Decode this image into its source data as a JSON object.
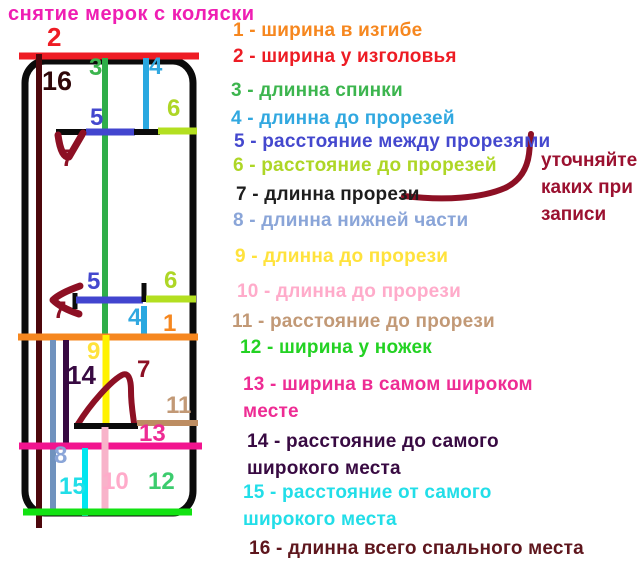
{
  "header": {
    "title": "снятие мерок с коляски",
    "color": "#ef1eb3"
  },
  "note": {
    "text": "уточняйте\nкаких при\nзаписи",
    "color": "#9b1130"
  },
  "diagram": {
    "stroke_colors": {
      "black": "#0b0b0b",
      "red": "#ee1c24",
      "maroon": "#4d070c",
      "green": "#2fae49",
      "turquoise": "#29a8e0",
      "indigo": "#4245cf",
      "lime": "#b3df20",
      "darkred": "#8d1024",
      "orange": "#f6871f",
      "bluegray": "#7092be",
      "darkpurple": "#380a42",
      "yellow": "#fff200",
      "brown": "#bd8d62",
      "deeppink": "#f2148f",
      "rose": "#f8b3ca",
      "cyan": "#00e6f0",
      "brightgreen": "#12e212",
      "note_arrow": "#8d1024"
    },
    "labels": [
      {
        "t": "2",
        "c": "#ee1c24"
      },
      {
        "t": "16",
        "c": "#2f0709"
      },
      {
        "t": "3",
        "c": "#3cb54e"
      },
      {
        "t": "4",
        "c": "#31a8e0"
      },
      {
        "t": "5",
        "c": "#4448ce"
      },
      {
        "t": "6",
        "c": "#aed626"
      },
      {
        "t": "7",
        "c": "#8d1024"
      },
      {
        "t": "5",
        "c": "#4448ce"
      },
      {
        "t": "6",
        "c": "#aed626"
      },
      {
        "t": "7",
        "c": "#8d1024"
      },
      {
        "t": "4",
        "c": "#31a8e0"
      },
      {
        "t": "1",
        "c": "#f6871f"
      },
      {
        "t": "9",
        "c": "#ffe23c"
      },
      {
        "t": "14",
        "c": "#380a42"
      },
      {
        "t": "7",
        "c": "#8d1024"
      },
      {
        "t": "11",
        "c": "#c29976"
      },
      {
        "t": "13",
        "c": "#ee2c94"
      },
      {
        "t": "8",
        "c": "#8aa5d8"
      },
      {
        "t": "15",
        "c": "#22dee8"
      },
      {
        "t": "10",
        "c": "#ffabca"
      },
      {
        "t": "12",
        "c": "#3ccc6e"
      }
    ]
  },
  "legend": {
    "items": [
      {
        "label": "1 - ширина в изгибе",
        "color": "#f6871f"
      },
      {
        "label": "2 - ширина у изголовья",
        "color": "#ed1c24"
      },
      {
        "label": "3 - длинна спинки",
        "color": "#3cb54e"
      },
      {
        "label": "4 - длинна до прорезей",
        "color": "#31a8e0"
      },
      {
        "label": "5 - расстояние между прорезями",
        "color": "#4448ce"
      },
      {
        "label": "6 - расстояние до прорезей",
        "color": "#aed626"
      },
      {
        "label": "7 - длинна прорези",
        "color": "#1d1d1d"
      },
      {
        "label": "8 - длинна нижней части",
        "color": "#8aa5d8"
      },
      {
        "label": "9 - длинна до прорези",
        "color": "#ffe23c"
      },
      {
        "label": "10 - длинна до прорези",
        "color": "#ffabca"
      },
      {
        "label": "11 - расстояние до прорези",
        "color": "#c29976"
      },
      {
        "label": "12 - ширина у ножек",
        "color": "#23d223"
      },
      {
        "label": "13 - ширина в самом широком\nместе",
        "color": "#ee2c94"
      },
      {
        "label": "14 - расстояние до самого\nширокого места",
        "color": "#380a42"
      },
      {
        "label": "15 - расстояние от самого\nширокого места",
        "color": "#22dee8"
      },
      {
        "label": "16 - длинна всего спального места",
        "color": "#5e161d"
      }
    ]
  }
}
